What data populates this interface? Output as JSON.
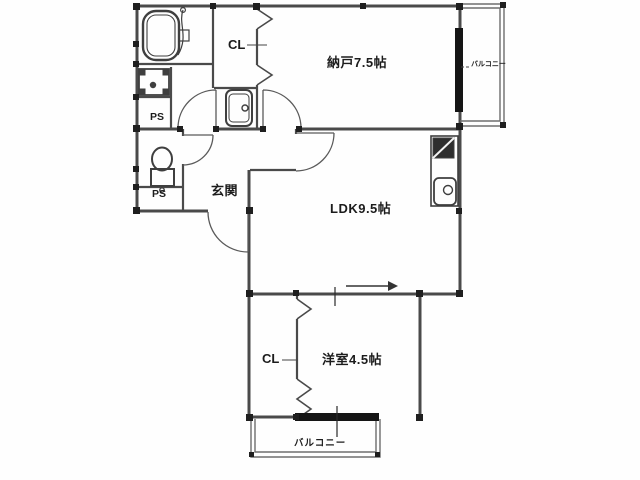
{
  "plan": {
    "type": "apartment-floor-plan",
    "labels": {
      "storage_room": "納戸7.5帖",
      "ldk": "LDK9.5帖",
      "western_room": "洋室4.5帖",
      "entrance": "玄関",
      "closet_upper": "CL",
      "closet_lower": "CL",
      "pipe_space_upper": "PS",
      "pipe_space_lower": "PS",
      "balcony_right": "バルコニー",
      "balcony_bottom": "バルコニー"
    },
    "fixtures": [
      "bathtub",
      "shower",
      "washing-machine-pan",
      "toilet",
      "washbasin",
      "kitchen-stove",
      "kitchen-sink"
    ],
    "colors": {
      "wall": "#4a4a4a",
      "thin_wall": "#6e6e6e",
      "window": "#151515",
      "fixture_line": "#3f3f3f",
      "background": "#fefefe",
      "text": "#1c1c1c"
    }
  }
}
